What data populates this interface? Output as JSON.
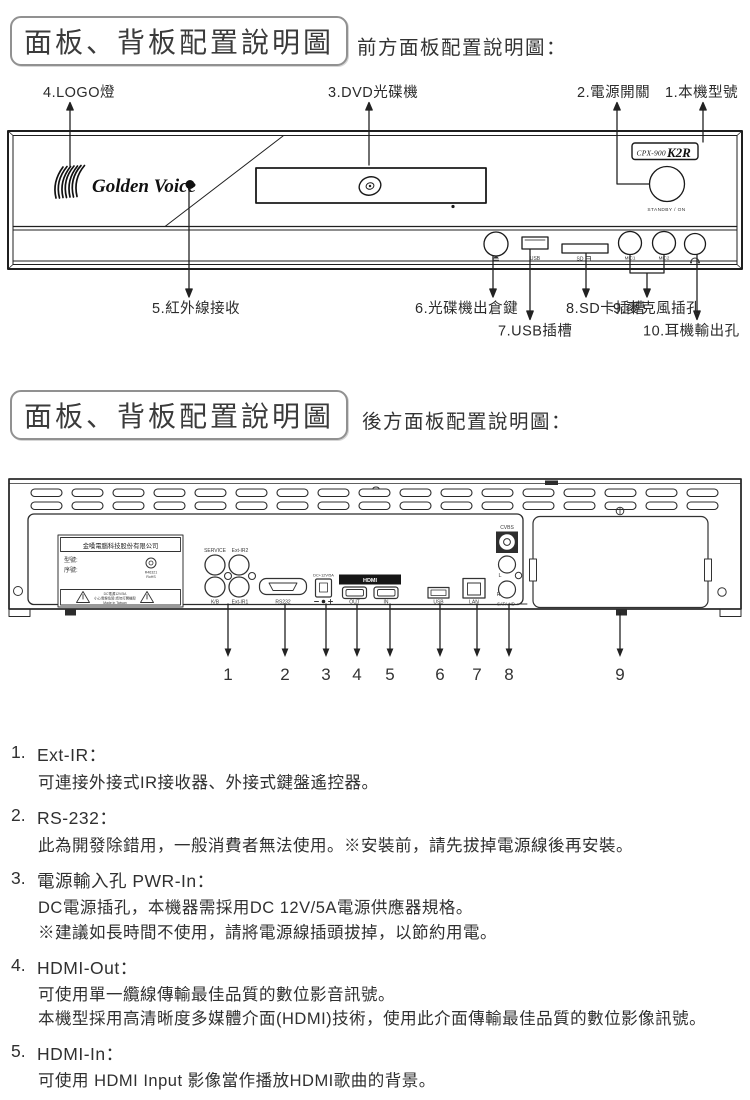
{
  "headers": {
    "sec1_title": "面板、背板配置說明圖",
    "sec1_subtitle": "前方面板配置說明圖：",
    "sec2_title": "面板、背板配置說明圖",
    "sec2_subtitle": "後方面板配置說明圖："
  },
  "front": {
    "callout_1": "1.本機型號",
    "callout_2": "2.電源開關",
    "callout_3": "3.DVD光碟機",
    "callout_4": "4.LOGO燈",
    "callout_5": "5.紅外線接收",
    "callout_6": "6.光碟機出倉鍵",
    "callout_7": "7.USB插槽",
    "callout_8": "8.SD卡插槽",
    "callout_9": "9.麥克風插孔",
    "callout_10": "10.耳機輸出孔",
    "brand": "Golden Voice",
    "model_prefix": "CPX-900",
    "model_name": "K2R",
    "power_label": "STANDBY / ON",
    "usb": "USB",
    "sd": "SD",
    "mic1": "MIC1",
    "mic2": "MIC2"
  },
  "back": {
    "company": "金嗓電腦科技股份有限公司",
    "model_field": "型號:",
    "serial_field": "序號:",
    "rohs_code": "R46321",
    "rohs": "RoHS",
    "warn_line1": "DC電源12V/5A",
    "warn_line2": "小心電擊危險 請勿打開機殼",
    "warn_line3": "Made in Taiwan",
    "service": "SERVICE",
    "ext_ir2": "Ext-IR2",
    "kb": "K/B",
    "ext_ir1": "Ext-IR1",
    "rs232": "RS232",
    "dc": "DC+12V/5A",
    "hdmi": "HDMI",
    "hdmi_out": "OUT",
    "hdmi_in": "IN",
    "usb": "USB",
    "lan": "LAN",
    "cvbs": "CVBS",
    "left": "L",
    "right": "R",
    "sata": "SATA HD",
    "numbers": [
      "1",
      "2",
      "3",
      "4",
      "5",
      "6",
      "7",
      "8",
      "9"
    ]
  },
  "descriptions": {
    "items": [
      {
        "num": "1.",
        "title": "Ext-IR：",
        "line1": "可連接外接式IR接收器、外接式鍵盤遙控器。"
      },
      {
        "num": "2.",
        "title": "RS-232：",
        "line1": "此為開發除錯用，一般消費者無法使用。※安裝前，請先拔掉電源線後再安裝。"
      },
      {
        "num": "3.",
        "title": "電源輸入孔 PWR-In：",
        "line1": "DC電源插孔，本機器需採用DC 12V/5A電源供應器規格。",
        "line2": "※建議如長時間不使用，請將電源線插頭拔掉，以節約用電。"
      },
      {
        "num": "4.",
        "title": "HDMI-Out：",
        "line1": "可使用單一纜線傳輸最佳品質的數位影音訊號。",
        "line2": "本機型採用高清晰度多媒體介面(HDMI)技術，使用此介面傳輸最佳品質的數位影像訊號。"
      },
      {
        "num": "5.",
        "title": "HDMI-In：",
        "line1": "可使用 HDMI Input 影像當作播放HDMI歌曲的背景。"
      }
    ]
  }
}
